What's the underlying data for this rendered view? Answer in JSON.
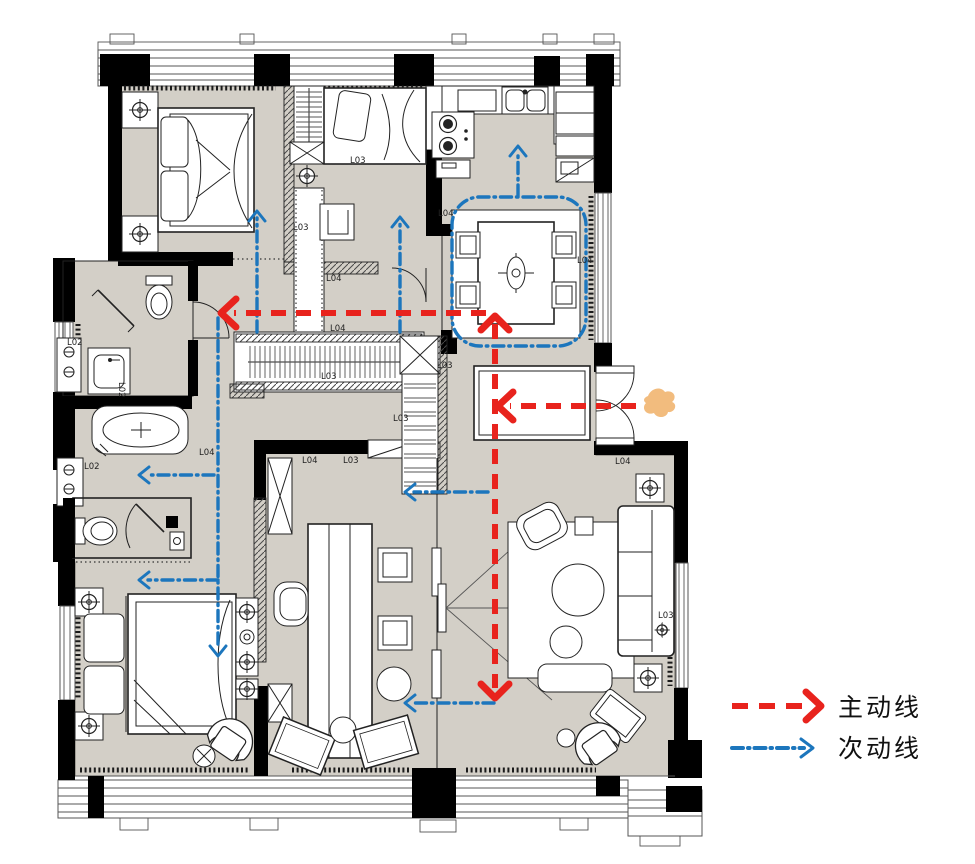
{
  "legend": {
    "items": [
      {
        "id": "main-line",
        "label": "主动线",
        "color": "#e8231d",
        "style": "dashed-arrow"
      },
      {
        "id": "secondary-line",
        "label": "次动线",
        "color": "#1c76bd",
        "style": "dash-dot-arrow"
      }
    ]
  },
  "floor_plan": {
    "colors": {
      "floor_fill": "#d3cfc7",
      "wall": "#000000",
      "main_line": "#e8231d",
      "secondary_line": "#1c76bd",
      "entry_marker": "#f2bc7e"
    },
    "labels": [
      {
        "text": "L03",
        "x": 350,
        "y": 163,
        "rot": 0
      },
      {
        "text": "L03",
        "x": 293,
        "y": 230,
        "rot": 0
      },
      {
        "text": "L04",
        "x": 326,
        "y": 281,
        "rot": 0
      },
      {
        "text": "L04",
        "x": 438,
        "y": 216,
        "rot": 0
      },
      {
        "text": "L04",
        "x": 577,
        "y": 263,
        "rot": 0
      },
      {
        "text": "L04",
        "x": 330,
        "y": 331,
        "rot": 0
      },
      {
        "text": "L03",
        "x": 321,
        "y": 379,
        "rot": 0
      },
      {
        "text": "L03",
        "x": 437,
        "y": 368,
        "rot": 0
      },
      {
        "text": "L03",
        "x": 393,
        "y": 421,
        "rot": 0
      },
      {
        "text": "L04",
        "x": 199,
        "y": 455,
        "rot": 0
      },
      {
        "text": "L02",
        "x": 67,
        "y": 345,
        "rot": 0
      },
      {
        "text": "L02",
        "x": 119,
        "y": 382,
        "rot": 90
      },
      {
        "text": "L02",
        "x": 84,
        "y": 469,
        "rot": 0
      },
      {
        "text": "L04",
        "x": 302,
        "y": 463,
        "rot": 0
      },
      {
        "text": "L03",
        "x": 343,
        "y": 463,
        "rot": 0
      },
      {
        "text": "L04",
        "x": 615,
        "y": 464,
        "rot": 0
      },
      {
        "text": "L03",
        "x": 658,
        "y": 618,
        "rot": 0
      }
    ]
  }
}
